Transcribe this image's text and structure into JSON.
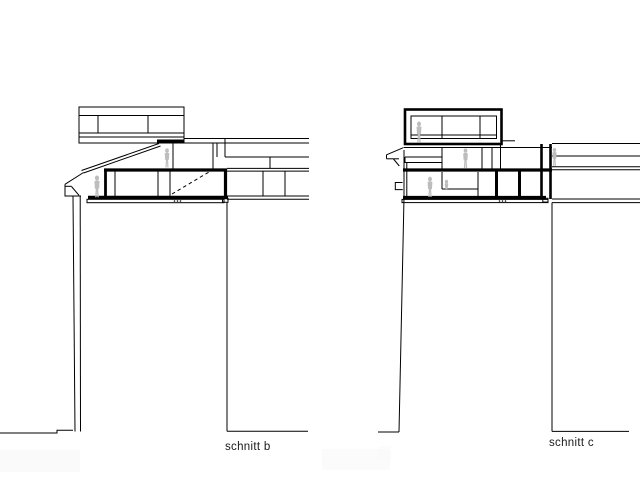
{
  "colors": {
    "background": "#ffffff",
    "line": "#000000",
    "figure": "#bdbdbd",
    "label_text": "#1a1a1a",
    "shadow_patch": "#fafafa"
  },
  "sections": [
    {
      "id": "b",
      "label": "schnitt b",
      "figure_count": 2
    },
    {
      "id": "c",
      "label": "schnitt c",
      "figure_count": 5
    }
  ]
}
